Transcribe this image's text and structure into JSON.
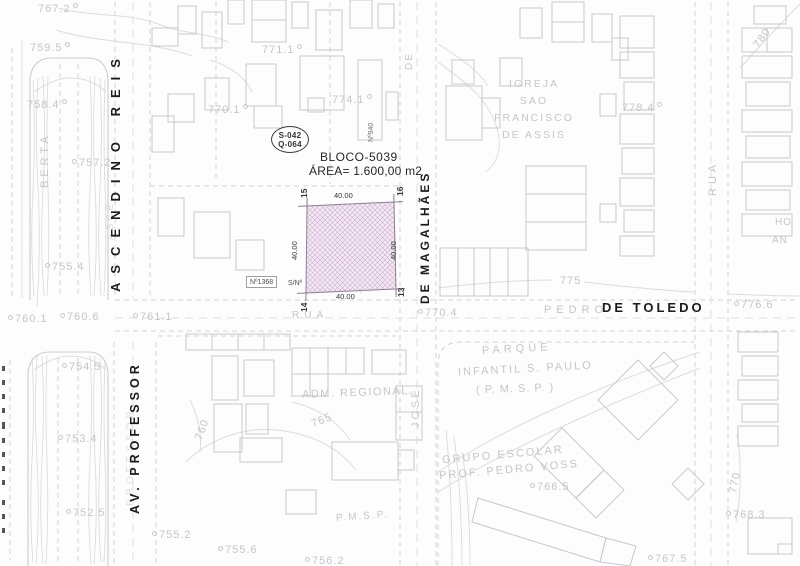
{
  "colors": {
    "dark_text": "#1b1b1b",
    "light_text": "#c3c7ca",
    "plot_fill": "#f3e9f4",
    "plot_hatch": "#cfaed0",
    "plot_border": "#8d7f90"
  },
  "plot": {
    "block_label": "BLOCO-5039",
    "area_label": "ÁREA= 1.600,00 m2",
    "ref_line1": "S-042",
    "ref_line2": "Q-064",
    "corner_15": "15",
    "corner_16": "16",
    "corner_13": "13",
    "corner_14": "14",
    "dim_top": "40.00",
    "dim_bottom": "40.00",
    "dim_left": "40.00",
    "dim_right": "40.00",
    "address_box": "Nº1368",
    "address_sn": "S/Nº",
    "address_n940": "Nº940"
  },
  "streets": {
    "ascendino_reis": "ASCENDINO REIS",
    "ascendino_ghost": "ASCE",
    "av_professor": "AV. PROFESSOR",
    "professor_ghost": "PROFESSOR",
    "de_magalhaes": "DE MAGALHÃES",
    "de_upper": "DE",
    "jose": "JOSÉ",
    "pedro": "PEDRO",
    "de_toledo": "DE TOLEDO",
    "rua_plot": "RUA",
    "rua_right": "RUA",
    "berta": "BERTA"
  },
  "places": {
    "igreja_l1": "IGREJA",
    "igreja_l2": "SAO",
    "igreja_l3": "FRANCISCO",
    "igreja_l4": "DE ASSIS",
    "adm": "ADM. REGIONAL",
    "parque_l1": "PARQUE",
    "parque_l2": "INFANTIL S. PAULO",
    "parque_l3": "( P. M. S. P. )",
    "grupo_l1": "GRUPO ESCOLAR",
    "grupo_l2": "PROF. PEDRO VOSS",
    "pmsp": "P.M.S.P.",
    "truncated_ho": "HO",
    "truncated_an": "AN"
  },
  "contours": {
    "c775": "775",
    "c780": "780",
    "c765": "765",
    "c760": "760",
    "c770": "770"
  },
  "elevations": [
    "767.2",
    "759.5",
    "758.4",
    "757.2",
    "755.4",
    "771.1",
    "770.1",
    "774.1",
    "778.4",
    "776.6",
    "770.4",
    "760.1",
    "760.6",
    "761.1",
    "754.5",
    "753.4",
    "752.5",
    "755.2",
    "755.6",
    "756.2",
    "766.5",
    "768.3",
    "767.5"
  ]
}
